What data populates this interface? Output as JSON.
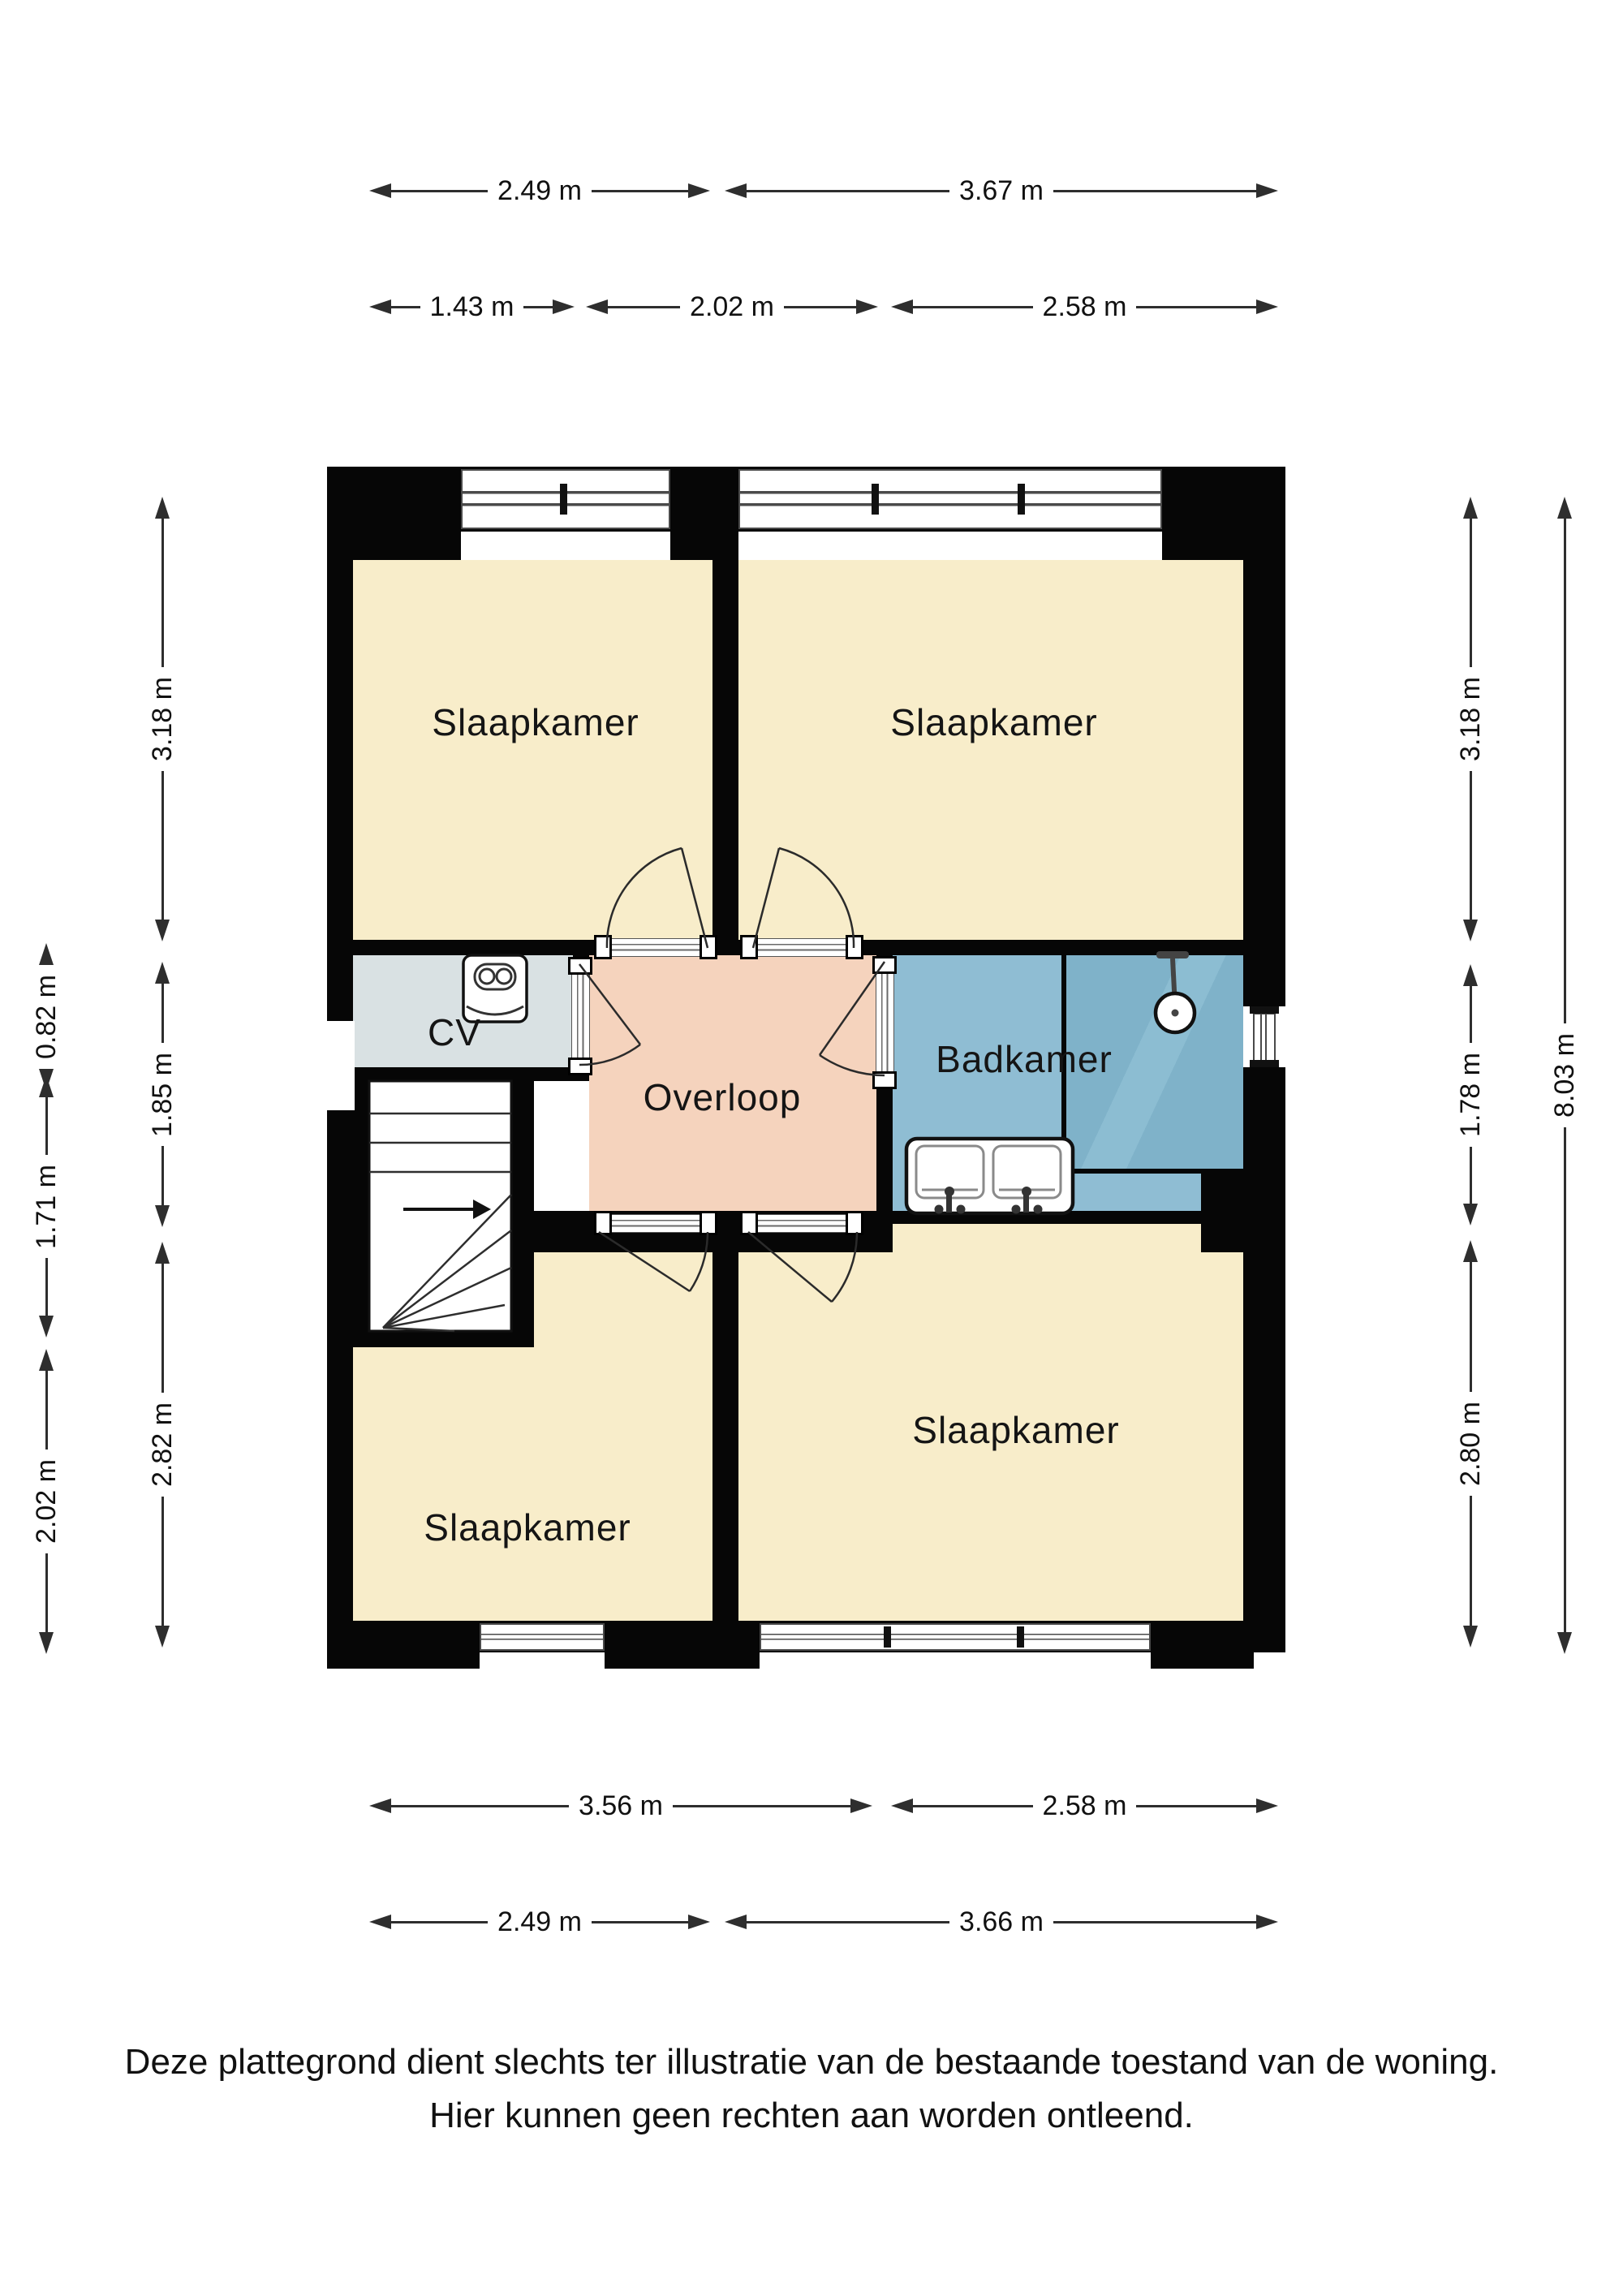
{
  "plan_title": "Verdieping plattegrond",
  "rooms": {
    "bedroom_tl": "Slaapkamer",
    "bedroom_tr": "Slaapkamer",
    "bedroom_bl": "Slaapkamer",
    "bedroom_br": "Slaapkamer",
    "cv": "CV",
    "hall": "Overloop",
    "bathroom": "Badkamer"
  },
  "dims": {
    "top_row1": [
      "2.49 m",
      "3.67 m"
    ],
    "top_row2": [
      "1.43 m",
      "2.02 m",
      "2.58 m"
    ],
    "bottom_row1": [
      "3.56 m",
      "2.58 m"
    ],
    "bottom_row2": [
      "2.49 m",
      "3.66 m"
    ],
    "left_outer": [
      "0.82 m",
      "1.71 m",
      "2.02 m"
    ],
    "left_inner": [
      "3.18 m",
      "1.85 m",
      "2.82 m"
    ],
    "right_inner": [
      "3.18 m",
      "1.78 m",
      "2.80 m"
    ],
    "right_outer": [
      "8.03 m"
    ]
  },
  "footer": {
    "line1": "Deze plattegrond dient slechts ter illustratie van de bestaande toestand van de woning.",
    "line2": "Hier kunnen geen rechten aan worden ontleend."
  },
  "icons": {
    "boiler": "boiler-icon",
    "shower": "shower-head-icon",
    "sink": "double-sink-icon",
    "stairs": "staircase-icon",
    "stairs_arrow": "stairs-direction-arrow-icon"
  },
  "colors": {
    "bedroom_fill": "#f8edca",
    "hall_fill": "#f5d3bd",
    "bathroom_fill": "#8fbdd3",
    "shower_fill": "#7fb2c9",
    "cv_fill": "#d9e1e3",
    "wall": "#060606",
    "dimension": "#2e2e2e"
  }
}
